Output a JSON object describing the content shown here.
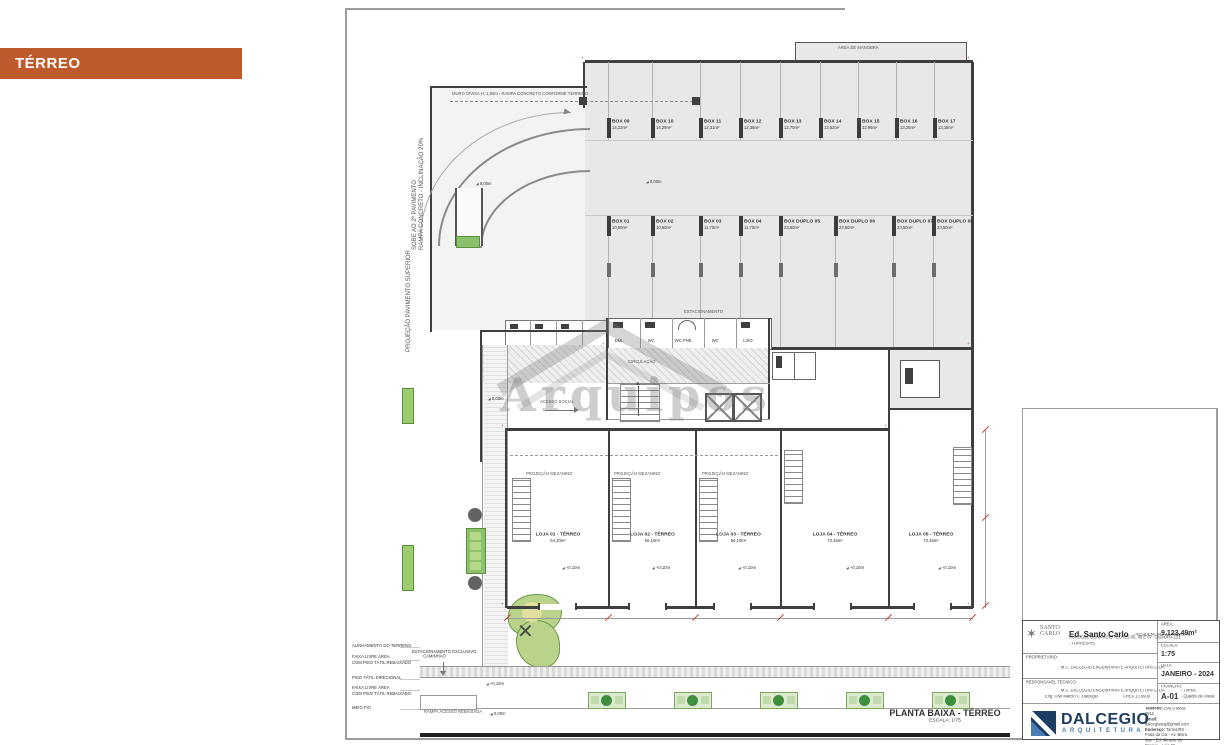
{
  "colors": {
    "accent_orange": "#BE5A2B",
    "navy": "#1D3C63",
    "blue": "#4A7DB5",
    "green": "#6FA84C",
    "paper": "#FFFFFF"
  },
  "tag": {
    "label": "TÉRREO"
  },
  "watermark": {
    "text": "Arquipos"
  },
  "caption": {
    "title": "PLANTA BAIXA - TÉRREO",
    "scale": "ESCALA: 1/75"
  },
  "plan": {
    "boxes_top": [
      {
        "name": "BOX 09",
        "area": "14,22m²"
      },
      {
        "name": "BOX 10",
        "area": "14,29m²"
      },
      {
        "name": "BOX 11",
        "area": "12,31m²"
      },
      {
        "name": "BOX 12",
        "area": "12,36m²"
      },
      {
        "name": "BOX 13",
        "area": "12,70m²"
      },
      {
        "name": "BOX 14",
        "area": "13,52m²"
      },
      {
        "name": "BOX 15",
        "area": "12,96m²"
      },
      {
        "name": "BOX 16",
        "area": "13,25m²"
      },
      {
        "name": "BOX 17",
        "area": "13,18m²"
      }
    ],
    "boxes_mid": [
      {
        "name": "BOX 01",
        "area": "10,50m²"
      },
      {
        "name": "BOX 02",
        "area": "10,50m²"
      },
      {
        "name": "BOX 03",
        "area": "11,70m²"
      },
      {
        "name": "BOX 04",
        "area": "11,70m²"
      },
      {
        "name": "BOX DUPLO 05",
        "area": "23,50m²"
      },
      {
        "name": "BOX DUPLO 06",
        "area": "23,50m²"
      },
      {
        "name": "BOX DUPLO 07",
        "area": "23,50m²"
      },
      {
        "name": "BOX DUPLO 08",
        "area": "23,50m²"
      }
    ],
    "lojas": [
      {
        "name": "LOJA 01 - TÉRREO",
        "area": "54,30m²"
      },
      {
        "name": "LOJA 02 - TÉRREO",
        "area": "56,10m²"
      },
      {
        "name": "LOJA 03 - TÉRREO",
        "area": "56,10m²"
      },
      {
        "name": "LOJA 04 - TÉRREO",
        "area": "73,45m²"
      },
      {
        "name": "LOJA 05 - TÉRREO",
        "area": "73,45m²"
      }
    ],
    "rooms": [
      "DML",
      "WC",
      "WC PNE",
      "WC",
      "LIXO"
    ],
    "labels": {
      "muro": "MURO DIVISA H: 1,80m - RAMPA CONCRETO CONFORME TERRENO",
      "sobe": "SOBE AO 2º PAVIMENTO",
      "rampa": "RAMPA CONCRETO - INCLINAÇÃO 20%",
      "projecao": "PROJEÇÃO PAVIMENTO SUPERIOR",
      "estacionamento": "ESTACIONAMENTO",
      "circulacao": "CIRCULAÇÃO",
      "acesso_social": "ACESSO SOCIAL",
      "area_manobra": "ÁREA DE MANOBRA",
      "mezanino": "PROJEÇÃO MEZANINO",
      "passeio": "PASSEIO PAVIMENTADO",
      "canteiro": "CANTEIRO VERDE",
      "rampa_rebaixada": "RAMPA ACESSO REBAIXADA",
      "nivel_zero": "0,00m",
      "nivel_dez": "+0,10m"
    },
    "legend": {
      "l1": "ALINHAMENTO DO TERRENO",
      "l2a": "FAIXA LIVRE ÁREA",
      "l2b": "COM PISO TÁTIL REBAIXADO",
      "l3": "PISO TÁTIL DIRECIONAL",
      "l4a": "FAIXA LIVRE ÁREA",
      "l4b": "COM PISO TÁTIL REBAIXADO",
      "l5": "MEIO FIO",
      "est1": "ESTACIONAMENTO EXCLUSIVO",
      "est2": "CAMINHÃO"
    }
  },
  "titleblock": {
    "logo_line1": "SANTO",
    "logo_line2": "CARLO",
    "project_name": "Ed. Santo Carlo",
    "project_type": "- RESIDENCIAL / COMERCIAL",
    "address1": "RUA JOSÉ BONIFÁCIO - LOTES 05, 06 E 07 - QUADRA 121",
    "address2": "- TORRES/RS",
    "owner_label": "PROPRIETÁRIO:",
    "owner": "M.C. DALCEGIO ENGENHARIA E ARQUITETURA LTDA",
    "resp_label": "RESPONSÁVEL TÉCNICO:",
    "resp1": "M.C. DALCEGIO ENGENHARIA E ARQUITETURA LTDA",
    "resp2": "Eng. Civil Márcio C. Dalcegio",
    "resp3": "CREA 13.9500",
    "area_label": "ÁREA:",
    "area": "9.123,49m²",
    "escala_label": "ESCALA:",
    "escala": "1:75",
    "data_label": "DATA:",
    "data": "JANEIRO - 2024",
    "prancha_label": "PRANCHA:",
    "prancha": "A-01",
    "prancha_note1": "- Térreo",
    "prancha_note2": "- Quadro de Áreas",
    "brand": "DALCEGIO",
    "brand_sub": "ARQUITETURA",
    "tel_label": "Telefone:",
    "tel": "(54) 9 9999-9912",
    "email_label": "Email:",
    "email": "dalcegioarq@gmail.com",
    "end_label": "Endereço:",
    "end": "Torres/RS - Praia da Cal - Av. Beira Mar - Ed. Mirante do Parque - Loja 02"
  }
}
